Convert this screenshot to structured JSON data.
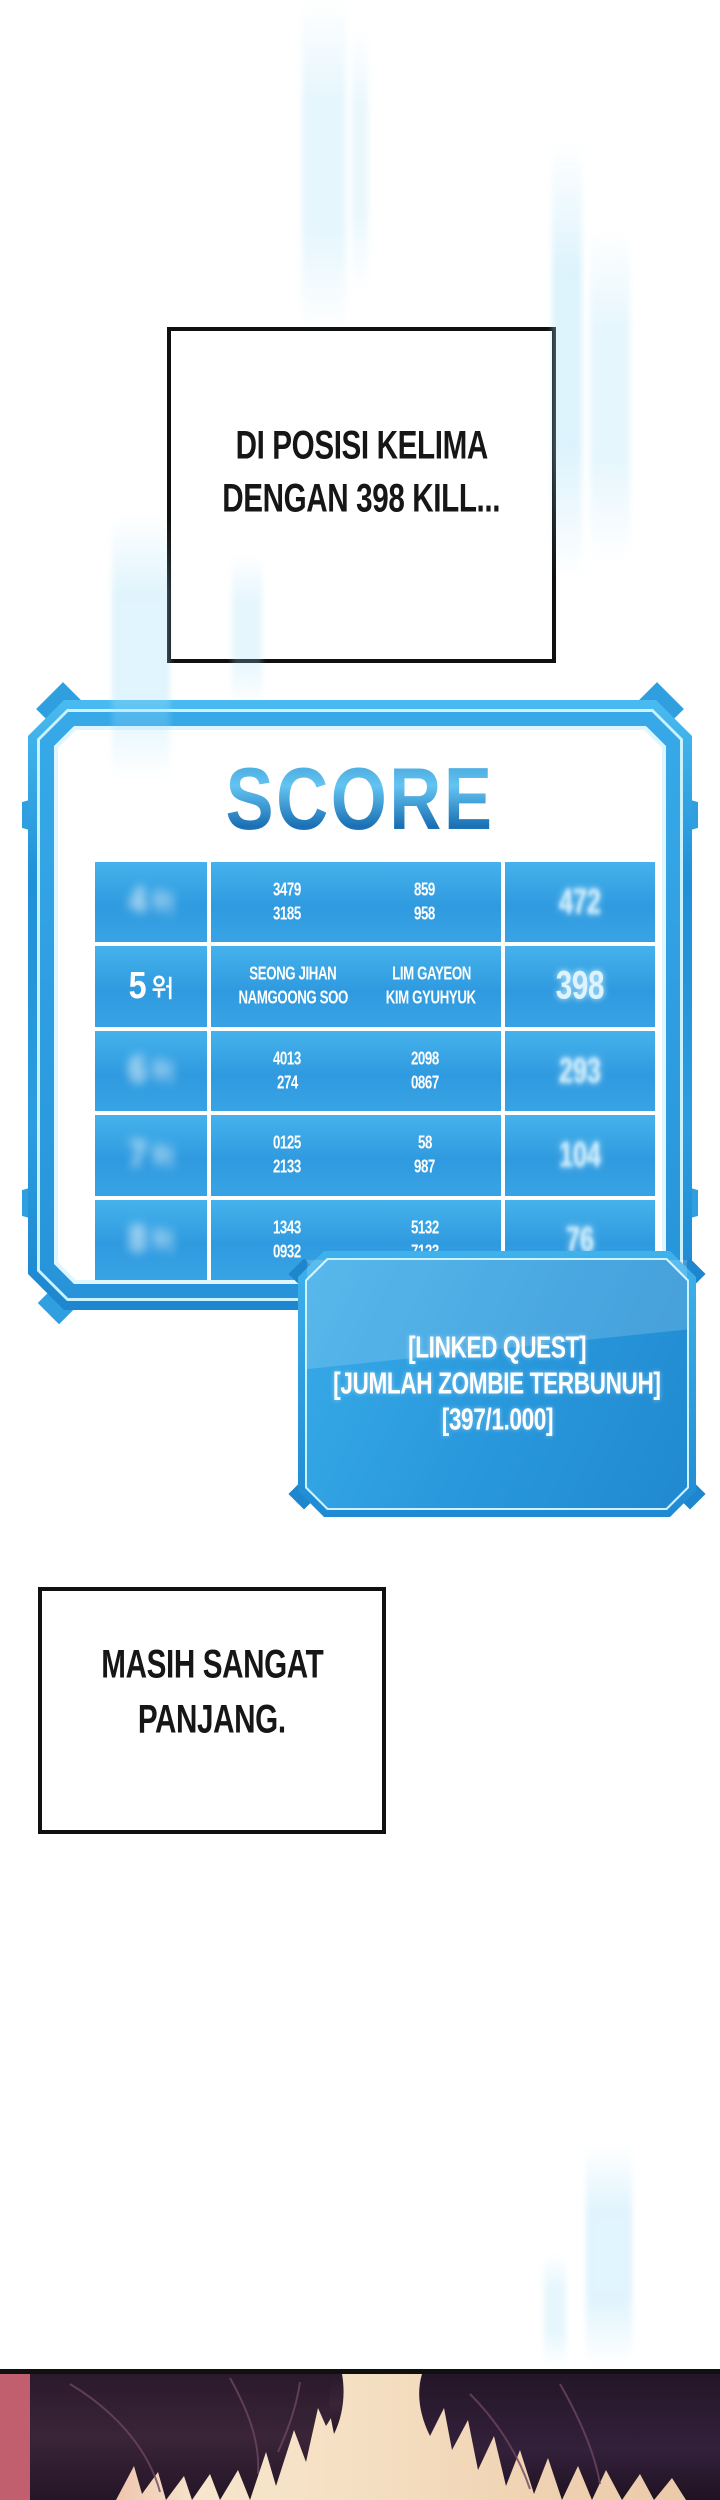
{
  "speech_top": {
    "line1": "DI POSISI KELIMA",
    "line2": "DENGAN 398 KILL..."
  },
  "score_panel": {
    "title": "SCORE",
    "rank_suffix": "위",
    "note": "rows 4,6,7,8 are blurred/illegible in source; placeholder glyphs only",
    "rows": [
      {
        "rank_num": "4",
        "name_a1": "3479",
        "name_b1": "859",
        "name_a2": "3185",
        "name_b2": "958",
        "score": "472",
        "legible": false
      },
      {
        "rank_num": "5",
        "name_a1": "SEONG JIHAN",
        "name_b1": "LIM GAYEON",
        "name_a2": "NAMGOONG SOO",
        "name_b2": "KIM GYUHYUK",
        "score": "398",
        "legible": true
      },
      {
        "rank_num": "6",
        "name_a1": "4013",
        "name_b1": "2098",
        "name_a2": "274",
        "name_b2": "0867",
        "score": "293",
        "legible": false
      },
      {
        "rank_num": "7",
        "name_a1": "0125",
        "name_b1": "58",
        "name_a2": "2133",
        "name_b2": "987",
        "score": "104",
        "legible": false
      },
      {
        "rank_num": "8",
        "name_a1": "1343",
        "name_b1": "5132",
        "name_a2": "0932",
        "name_b2": "7123",
        "score": "76",
        "legible": false
      }
    ]
  },
  "quest_panel": {
    "line1": "[LINKED QUEST]",
    "line2": "[JUMLAH ZOMBIE TERBUNUH]",
    "line3": "[397/1.000]"
  },
  "speech_bottom": {
    "line1": "MASIH SANGAT",
    "line2": "PANJANG."
  },
  "colors": {
    "panel_blue": "#2f9fe0",
    "panel_blue_dark": "#1f8ad2",
    "cyan_line": "#cdf2ff",
    "cell_blue": "#35a5e5",
    "score_glow": "#ddf4ff",
    "rose_bg": "#c25f6e",
    "cream_bg": "#f6e2c8",
    "hair_dark": "#342134",
    "border_black": "#101010"
  }
}
